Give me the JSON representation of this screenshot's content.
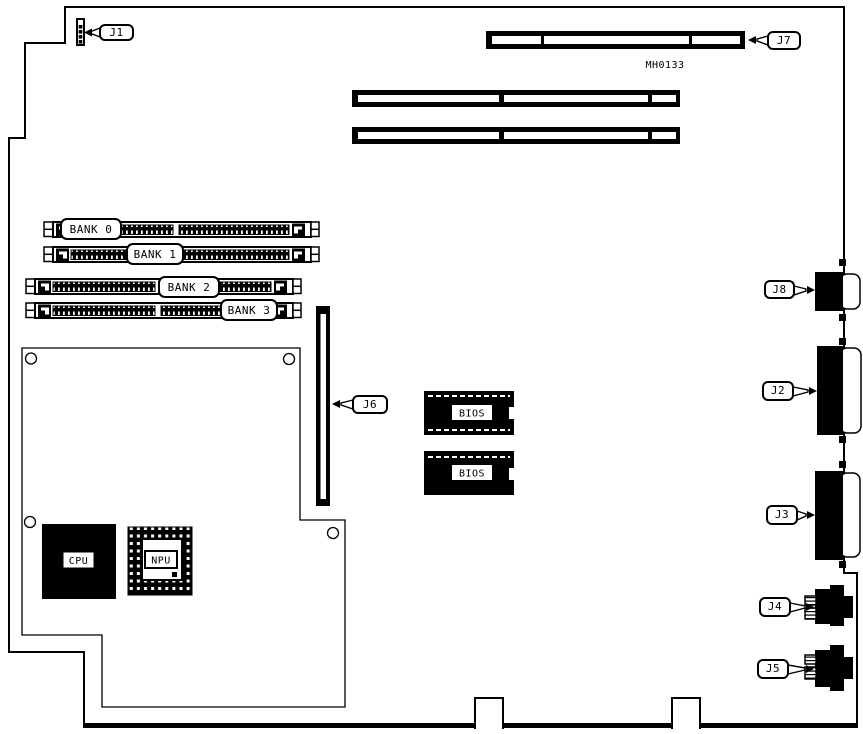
{
  "diagram": {
    "part_number": "MH0133",
    "connectors": {
      "j1": "J1",
      "j2": "J2",
      "j3": "J3",
      "j4": "J4",
      "j5": "J5",
      "j6": "J6",
      "j7": "J7",
      "j8": "J8"
    },
    "memory_banks": {
      "bank0": "BANK 0",
      "bank1": "BANK 1",
      "bank2": "BANK 2",
      "bank3": "BANK 3"
    },
    "chips": {
      "cpu": "CPU",
      "npu": "NPU",
      "bios_top": "BIOS",
      "bios_bottom": "BIOS"
    },
    "colors": {
      "ink": "#000000",
      "paper": "#ffffff"
    }
  }
}
